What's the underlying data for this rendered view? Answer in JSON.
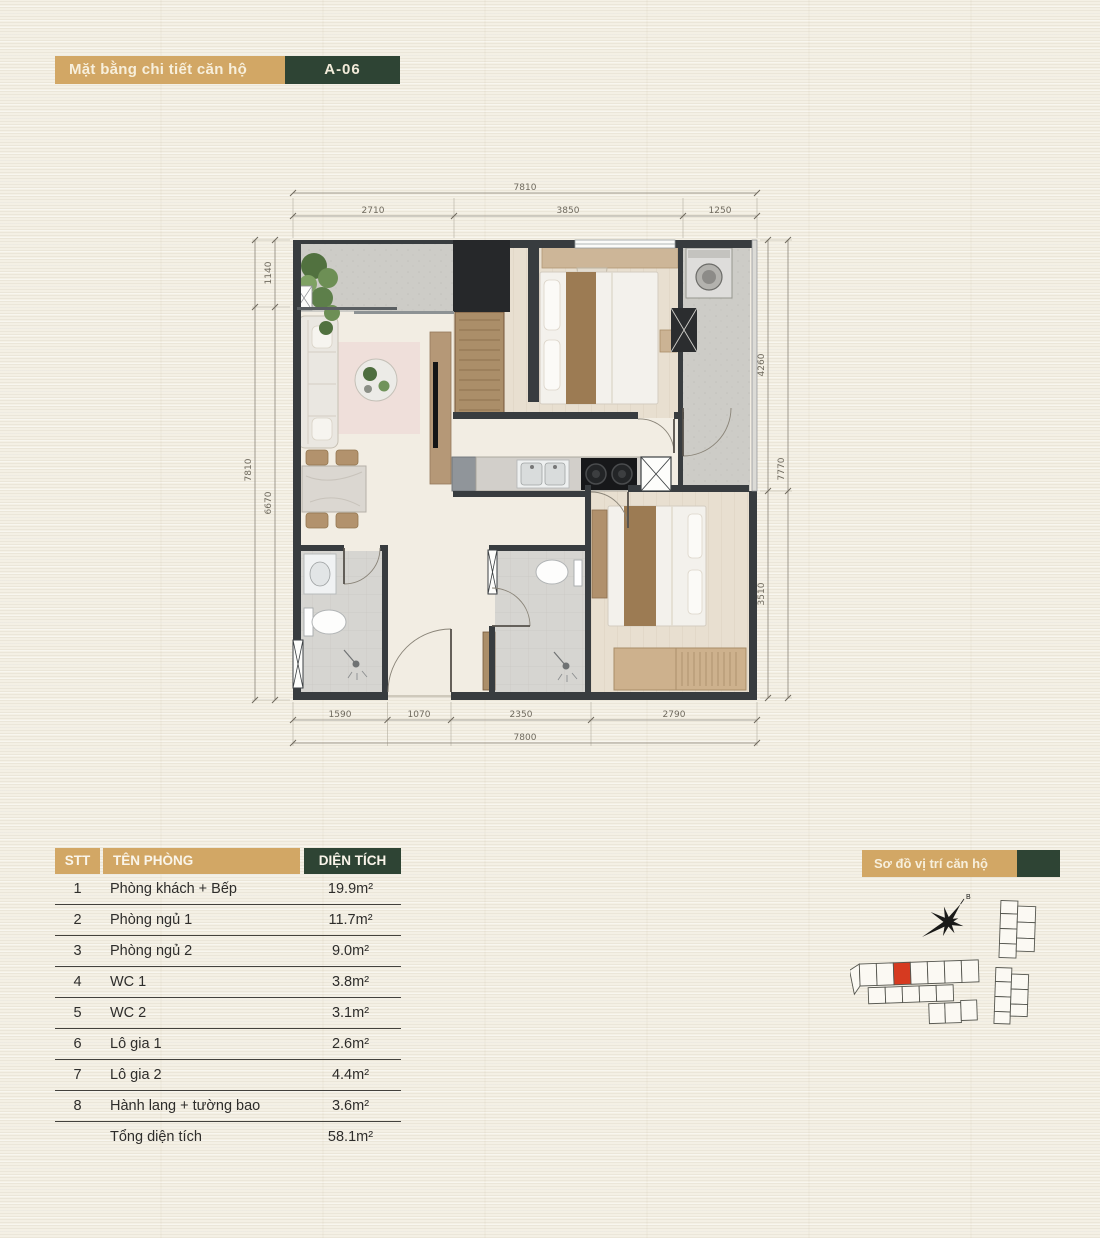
{
  "header": {
    "title": "Mặt bằng chi tiết căn hộ",
    "unit": "A-06"
  },
  "floor_plan": {
    "dims_top": {
      "overall": "7810",
      "segments": [
        "2710",
        "3850",
        "1250"
      ]
    },
    "dims_bottom": {
      "overall": "7800",
      "segments": [
        "1590",
        "1070",
        "2350",
        "2790"
      ]
    },
    "dims_left": {
      "overall": "7810",
      "segments": [
        "1140",
        "6670"
      ]
    },
    "dims_right": {
      "overall": "7770",
      "segments": [
        "4260",
        "3510"
      ]
    }
  },
  "area_table": {
    "col_stt": "STT",
    "col_room": "TÊN PHÒNG",
    "col_area": "DIỆN TÍCH",
    "rows": [
      {
        "stt": "1",
        "room": "Phòng khách + Bếp",
        "area": "19.9m²"
      },
      {
        "stt": "2",
        "room": "Phòng ngủ 1",
        "area": "11.7m²"
      },
      {
        "stt": "3",
        "room": "Phòng ngủ 2",
        "area": "9.0m²"
      },
      {
        "stt": "4",
        "room": "WC 1",
        "area": "3.8m²"
      },
      {
        "stt": "5",
        "room": "WC 2",
        "area": "3.1m²"
      },
      {
        "stt": "6",
        "room": "Lô gia 1",
        "area": "2.6m²"
      },
      {
        "stt": "7",
        "room": "Lô gia 2",
        "area": "4.4m²"
      },
      {
        "stt": "8",
        "room": "Hành lang + tường bao",
        "area": "3.6m²"
      },
      {
        "stt": "",
        "room": "Tổng diện tích",
        "area": "58.1m²"
      }
    ]
  },
  "location": {
    "title": "Sơ đồ vị trí căn hộ",
    "compass_label": "B"
  },
  "colors": {
    "tan": "#d2a765",
    "green": "#2e4434",
    "wall": "#383c3f",
    "highlight": "#d63a20"
  }
}
